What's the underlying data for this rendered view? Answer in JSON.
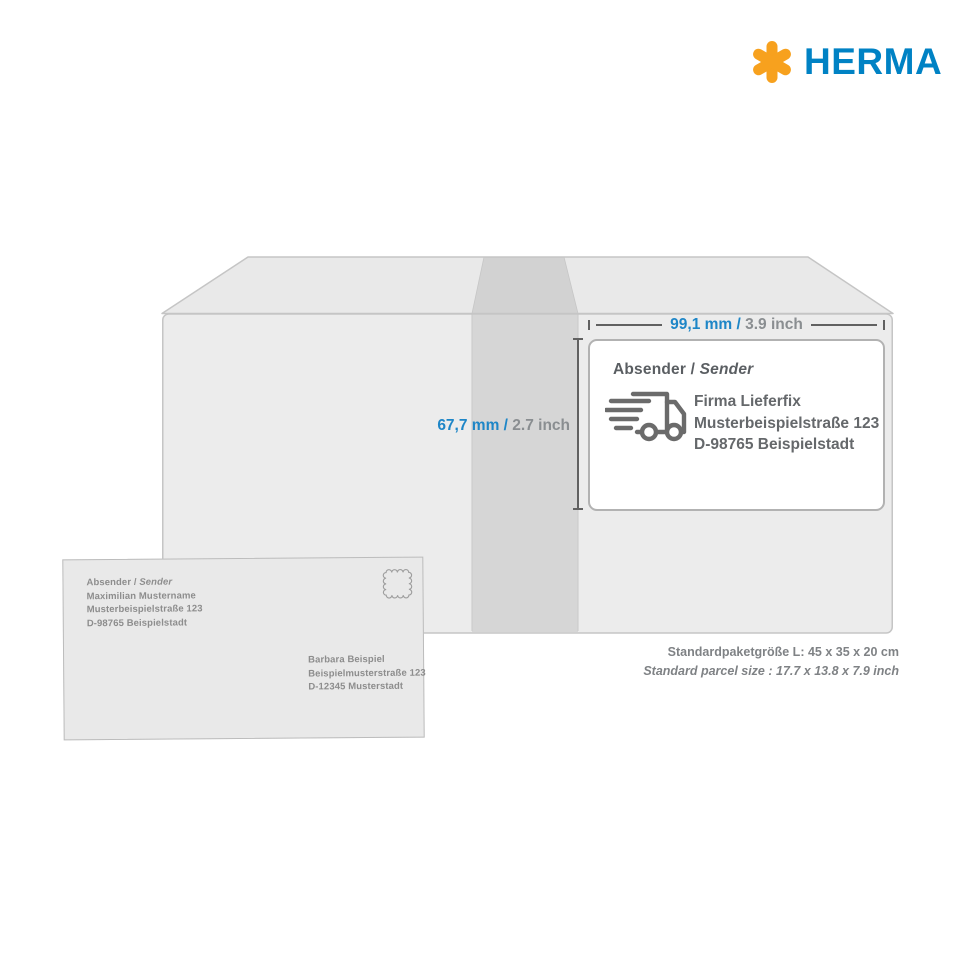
{
  "brand": {
    "name": "HERMA",
    "asterisk_icon": "herma-asterisk-icon"
  },
  "colors": {
    "herma_blue": "#0082C4",
    "herma_orange": "#F7A11E",
    "dimension_blue": "#1E86C7",
    "dimension_gray": "#8A8E91",
    "box_face": "#ECECEC",
    "box_tape": "#D5D5D5",
    "label_border": "#B2B2B2",
    "label_text": "#65686B",
    "envelope_fill": "#E9E9E9",
    "envelope_text": "#8D8D8D"
  },
  "dimensions": {
    "width": {
      "metric": "99,1 mm /",
      "imperial": "3.9 inch"
    },
    "height": {
      "metric": "67,7 mm /",
      "imperial": "2.7 inch"
    }
  },
  "label": {
    "heading_de": "Absender /",
    "heading_en": "Sender",
    "truck_icon": "delivery-truck-icon",
    "address_lines": [
      "Firma Lieferfix",
      "Musterbeispielstraße 123",
      "D-98765 Beispielstadt"
    ]
  },
  "envelope": {
    "sender_heading_de": "Absender /",
    "sender_heading_en": "Sender",
    "sender_lines": [
      "Maximilian Mustername",
      "Musterbeispielstraße 123",
      "D-98765 Beispielstadt"
    ],
    "stamp_icon": "stamp-icon",
    "recipient_lines": [
      "Barbara Beispiel",
      "Beispielmusterstraße 123",
      "D-12345 Musterstadt"
    ]
  },
  "caption": {
    "line_de": "Standardpaketgröße L: 45 x 35 x 20 cm",
    "line_en": "Standard parcel size : 17.7 x 13.8 x 7.9 inch"
  }
}
